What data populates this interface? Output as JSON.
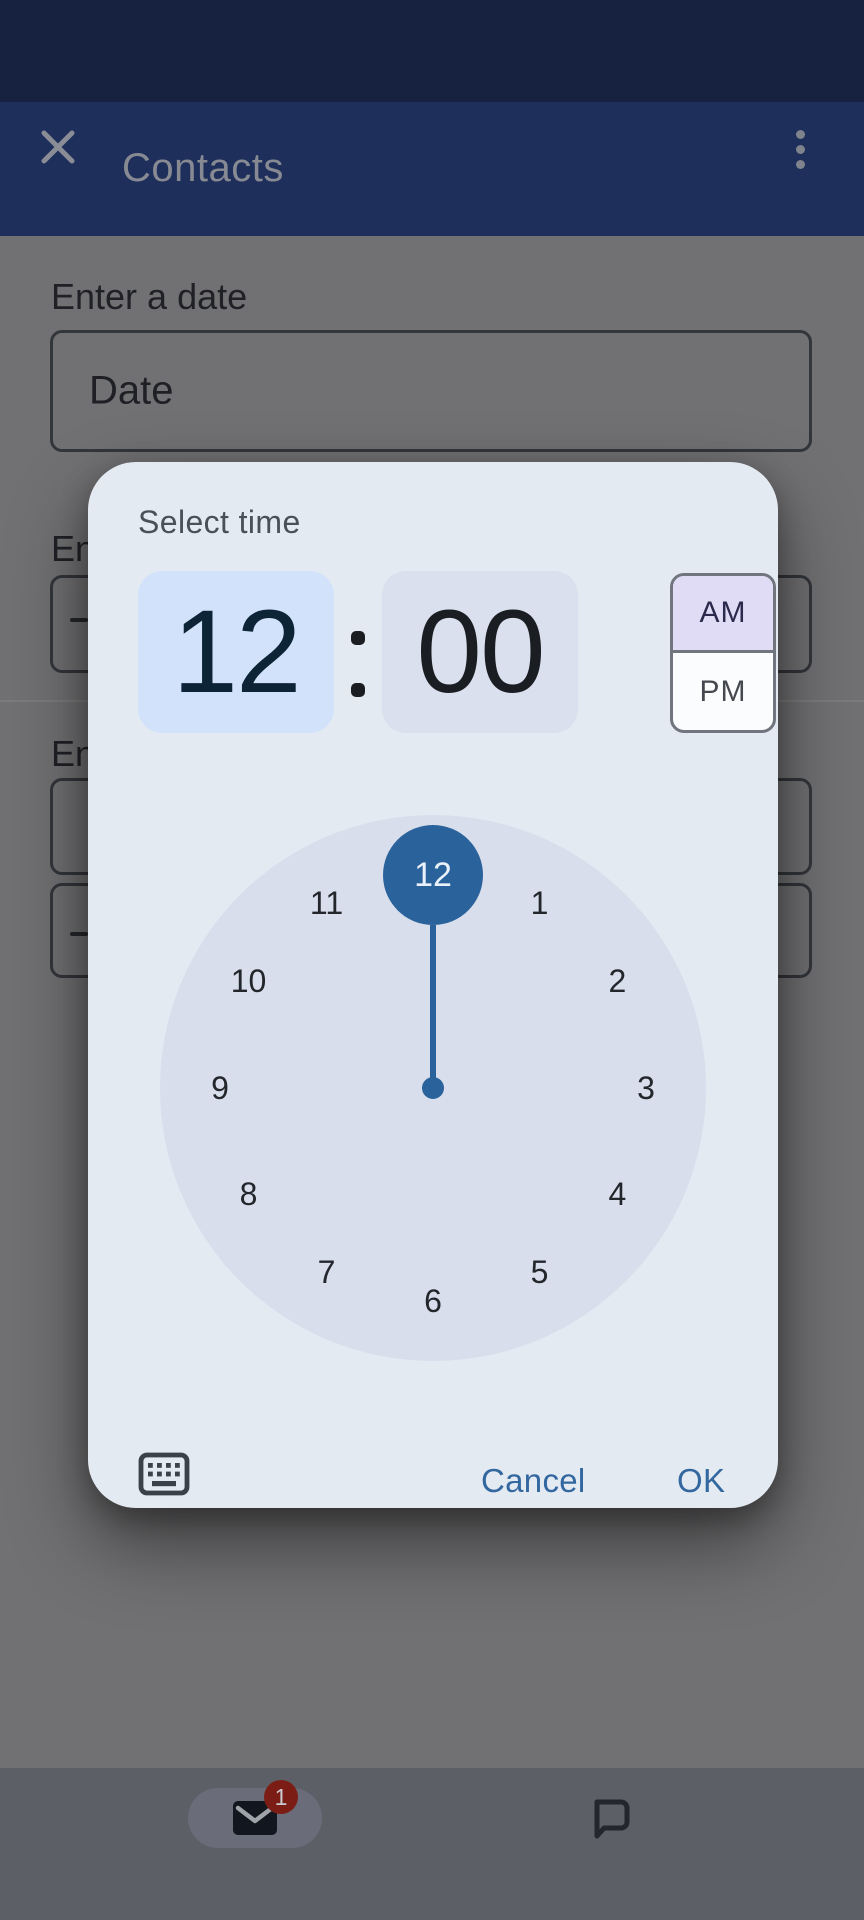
{
  "app_bar": {
    "title": "Contacts",
    "close_icon": "close-x",
    "overflow_icon": "vertical-kebab-menu"
  },
  "form": {
    "date_label": "Enter a date",
    "date_placeholder": "Date",
    "partial_label_1": "En",
    "partial_label_2": "En"
  },
  "dialog": {
    "title": "Select time",
    "hour": "12",
    "minute": "00",
    "period_options": [
      "AM",
      "PM"
    ],
    "selected_period": "AM",
    "am_label": "AM",
    "pm_label": "PM",
    "clock": {
      "hours": [
        12,
        1,
        2,
        3,
        4,
        5,
        6,
        7,
        8,
        9,
        10,
        11
      ],
      "selected_hour": 12
    },
    "keyboard_icon": "keyboard-input-toggle",
    "cancel_label": "Cancel",
    "ok_label": "OK"
  },
  "nav": {
    "mail_icon": "mail-envelope",
    "mail_badge": "1",
    "chat_icon": "chat-bubble"
  },
  "colors": {
    "status_bar": "#172240",
    "app_bar": "#1E2F5B",
    "scrim_background": "#717173",
    "dialog_surface": "#E4EAF2",
    "accent_blue": "#2A629B",
    "hour_field_bg": "#D2E2FA",
    "minute_field_bg": "#DBE0EE",
    "am_selected_bg": "#E1DCF6",
    "clock_face": "#D8DEEC",
    "action_text": "#33679F",
    "badge_red": "#7B1D15",
    "nav_bar": "#5C5F66"
  }
}
